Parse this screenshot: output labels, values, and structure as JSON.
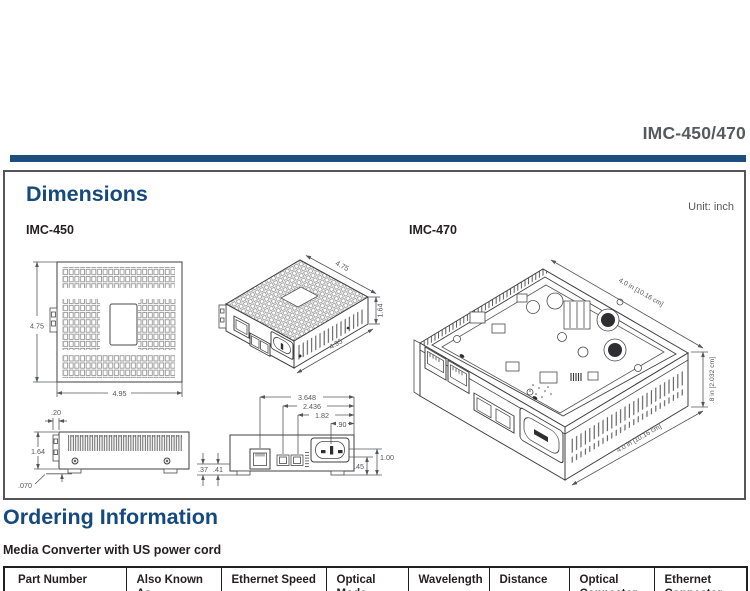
{
  "colors": {
    "accent_blue": "#16497e",
    "bar_blue": "#1e4e7e",
    "gray_text": "#58595b",
    "near_black": "#231f20"
  },
  "header": {
    "product": "IMC-450/470"
  },
  "dims": {
    "title": "Dimensions",
    "unit": "Unit: inch",
    "imc450_label": "IMC-450",
    "imc470_label": "IMC-470",
    "top_view": {
      "height": "4.75",
      "width": "4.95"
    },
    "iso450": {
      "top": "4.75",
      "height": "1.64",
      "front": "4.95"
    },
    "side": {
      "tab": ".20",
      "height": "1.64",
      "foot": ".070"
    },
    "rear": {
      "d1": "3.648",
      "d2": "2.436",
      "d3": "1.82",
      "d4": ".90",
      "left1": ".37",
      "left2": ".41",
      "right1": ".45",
      "right2": "1.00"
    },
    "iso470": {
      "top": "4.0 in [10.16 cm]",
      "height": ".8 in [2.032 cm]",
      "bottom": "4.0 in [10.16 cm]"
    }
  },
  "ordering": {
    "title": "Ordering Information",
    "subtitle": "Media Converter with US power cord",
    "table": {
      "headers": [
        "Part Number",
        "Also Known As",
        "Ethernet Speed",
        "Optical Mode",
        "Wavelength",
        "Distance",
        "Optical Connector",
        "Ethernet Connector"
      ]
    }
  }
}
